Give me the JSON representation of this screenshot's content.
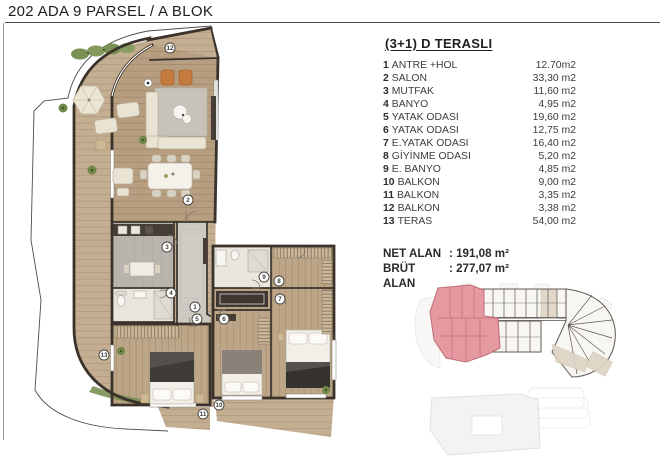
{
  "title": "202 ADA 9 PARSEL / A BLOK",
  "unit_card": {
    "heading": "(3+1) D TERASLI",
    "rooms": [
      {
        "num": "1",
        "label": "ANTRE +HOL",
        "area": "12.70m2"
      },
      {
        "num": "2",
        "label": "SALON",
        "area": "33,30 m2"
      },
      {
        "num": "3",
        "label": "MUTFAK",
        "area": "11,60 m2"
      },
      {
        "num": "4",
        "label": "BANYO",
        "area": "4,95 m2"
      },
      {
        "num": "5",
        "label": "YATAK ODASI",
        "area": "19,60 m2"
      },
      {
        "num": "6",
        "label": "YATAK ODASI",
        "area": "12,75 m2"
      },
      {
        "num": "7",
        "label": "E.YATAK ODASI",
        "area": "16,40 m2"
      },
      {
        "num": "8",
        "label": "GİYİNME ODASI",
        "area": "5,20 m2"
      },
      {
        "num": "9",
        "label": "E. BANYO",
        "area": "4,85 m2"
      },
      {
        "num": "10",
        "label": "BALKON",
        "area": "9,00 m2"
      },
      {
        "num": "11",
        "label": "BALKON",
        "area": "3,35 m2"
      },
      {
        "num": "12",
        "label": "BALKON",
        "area": "3,38 m2"
      },
      {
        "num": "13",
        "label": "TERAS",
        "area": "54,00 m2"
      }
    ],
    "summary": [
      {
        "label": "NET ALAN",
        "value": ": 191,08 m²"
      },
      {
        "label": "BRÜT ALAN",
        "value": ": 277,07 m²"
      }
    ]
  },
  "floor_plan": {
    "markers": [
      {
        "n": "1"
      },
      {
        "n": "2"
      },
      {
        "n": "3"
      },
      {
        "n": "4"
      },
      {
        "n": "5"
      },
      {
        "n": "6"
      },
      {
        "n": "7"
      },
      {
        "n": "8"
      },
      {
        "n": "9"
      },
      {
        "n": "10"
      },
      {
        "n": "11"
      },
      {
        "n": "12"
      },
      {
        "n": "13"
      }
    ]
  },
  "key_plan": {
    "highlight_color": "#e59aa2"
  },
  "colors": {
    "wall": "#3a322b",
    "terrace_wood": "#c4ae92",
    "salon_wood": "#b79e80",
    "bedroom_wood": "#bda687"
  }
}
